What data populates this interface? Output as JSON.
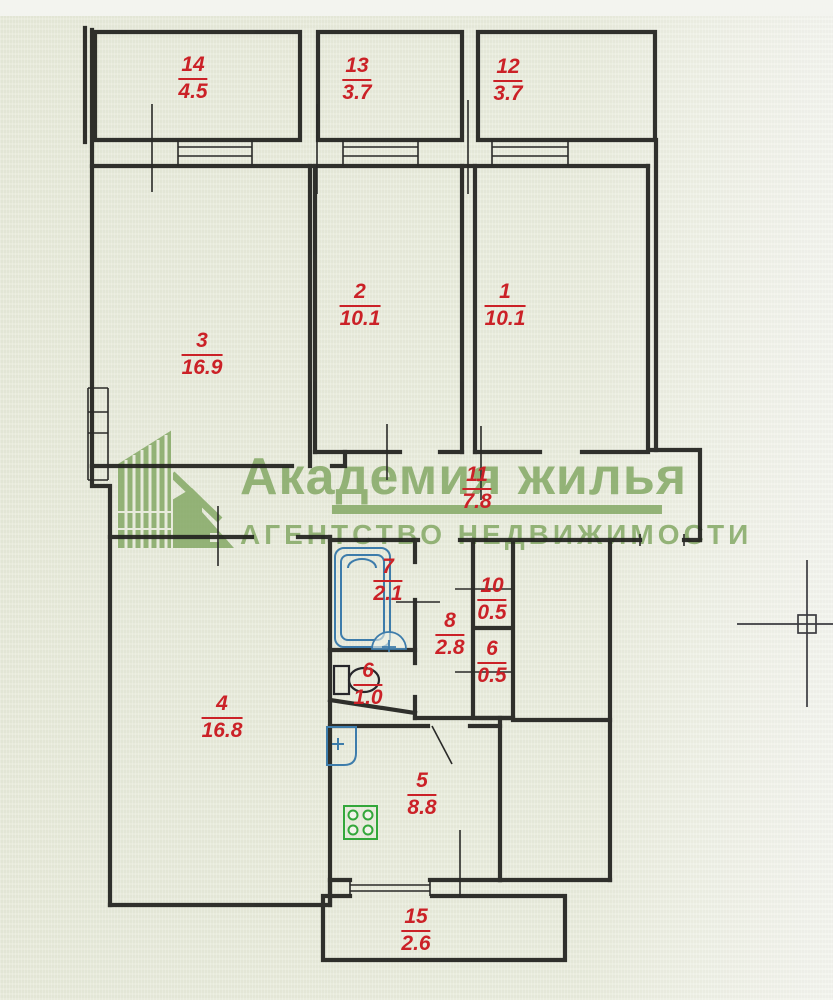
{
  "watermark": {
    "title": "Академия жилья",
    "subtitle": "АГЕНТСТВО НЕДВИЖИМОСТИ",
    "logo": "building-logo-icon",
    "color": "#7ea55e"
  },
  "plan": {
    "rooms": [
      {
        "number": "14",
        "area": "4.5"
      },
      {
        "number": "13",
        "area": "3.7"
      },
      {
        "number": "12",
        "area": "3.7"
      },
      {
        "number": "3",
        "area": "16.9"
      },
      {
        "number": "2",
        "area": "10.1"
      },
      {
        "number": "1",
        "area": "10.1"
      },
      {
        "number": "11",
        "area": "7.8"
      },
      {
        "number": "7",
        "area": "2.1"
      },
      {
        "number": "10",
        "area": "0.5"
      },
      {
        "number": "8",
        "area": "2.8"
      },
      {
        "number": "6",
        "area": "0.5"
      },
      {
        "number": "6",
        "area": "1.0"
      },
      {
        "number": "4",
        "area": "16.8"
      },
      {
        "number": "5",
        "area": "8.8"
      },
      {
        "number": "15",
        "area": "2.6"
      }
    ],
    "fixture_icons": [
      "bathtub-icon",
      "corner-sink-icon",
      "toilet-icon",
      "kitchen-sink-icon",
      "stove-icon"
    ],
    "cursor_icon": "cad-crosshair-icon"
  },
  "colors": {
    "room_label_red": "#cb2127",
    "watermark_green": "#7ea55e",
    "wall": "#22221f",
    "plumbing_blue": "#3d7cab",
    "stove_green": "#33a73a",
    "paper": "#e9ecdd"
  }
}
